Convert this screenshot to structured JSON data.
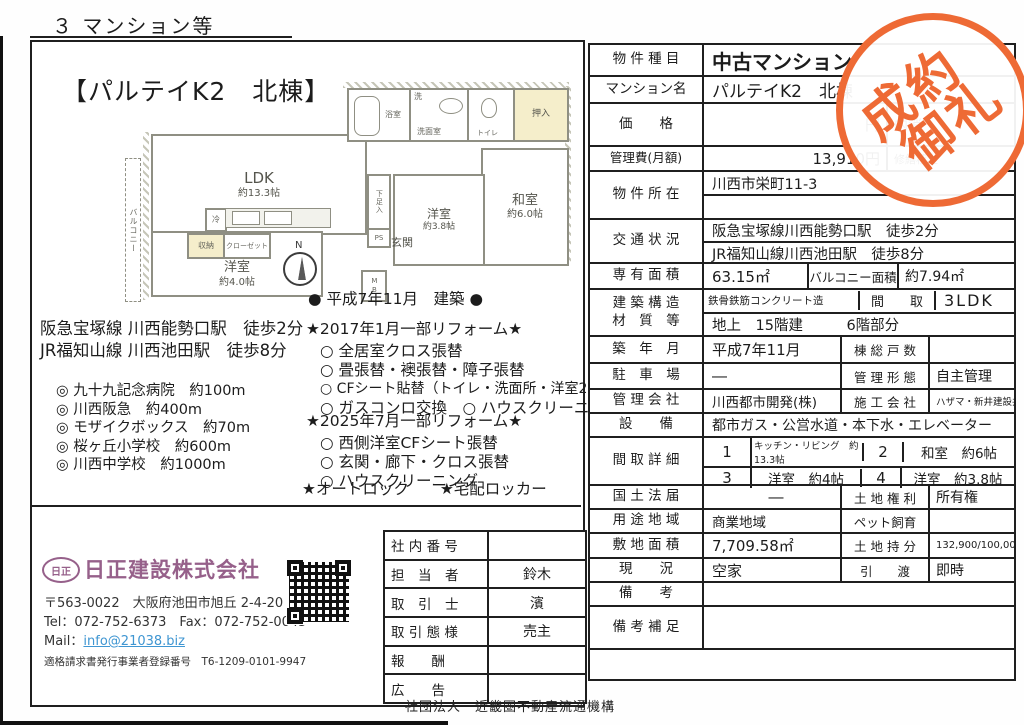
{
  "colors": {
    "stamp": "#ee6a35",
    "accent_purple": "#96608a",
    "link_blue": "#3f96d2",
    "tatami_yellow": "#f5eecb"
  },
  "page": {
    "header": "３ マンション等",
    "footer": "社団法人　近畿圏不動産流通機構"
  },
  "stamp": {
    "line1": "成約",
    "line2": "御礼"
  },
  "left": {
    "title": "【パルテイK2　北棟】",
    "built_note": "● 平成7年11月　建築 ●",
    "stations": [
      "阪急宝塚線 川西能勢口駅　徒歩2分",
      "JR福知山線 川西池田駅　徒歩8分"
    ],
    "nearby": [
      "◎ 九十九記念病院　約100m",
      "◎ 川西阪急　約400m",
      "◎ モザイクボックス　約70m",
      "◎ 桜ヶ丘小学校　約600m",
      "◎ 川西中学校　約1000m"
    ],
    "reform2017_title": "★2017年1月一部リフォーム★",
    "reform2017": [
      "○ 全居室クロス張替",
      "○ 畳張替・襖張替・障子張替",
      "○ CFシート貼替（トイレ・洗面所・洋室2部屋）",
      "○ ガスコンロ交換　○ ハウスクリーニング"
    ],
    "reform2025_title": "★2025年7月一部リフォーム★",
    "reform2025": [
      "○ 西側洋室CFシート張替",
      "○ 玄関・廊下・クロス張替",
      "○ ハウスクリーニング"
    ],
    "features": "★オートロック　　★宅配ロッカー"
  },
  "floorplan": {
    "balcony": "バルコニー",
    "ldk": "LDK",
    "ldk_size": "約13.3帖",
    "washitsu": "和室",
    "washitsu_size": "約6.0帖",
    "mid_room": "洋室",
    "mid_room_size": "約3.8帖",
    "west_room": "洋室",
    "west_room_size": "約4.0帖",
    "bath": "浴室",
    "wash": "洗",
    "wash_room": "洗面室",
    "toilet": "トイレ",
    "oshiire": "押入",
    "genkan": "玄関",
    "shoe_box": "下足入",
    "ps": "PS",
    "mb": "MB",
    "fridge": "冷",
    "storage": "収納",
    "closet": "クローゼット",
    "north": "N"
  },
  "company": {
    "logo": "日正",
    "name": "日正建設株式会社",
    "address": "〒563-0022　大阪府池田市旭丘 2-4-20",
    "tel_fax": "Tel：072-752-6373　Fax：072-752-0045",
    "mail_label": "Mail：",
    "mail": "info@21038.biz",
    "invoice": "適格請求書発行事業者登録番号　T6-1209-0101-9947"
  },
  "agent": {
    "rows": [
      {
        "label": "社 内 番 号",
        "value": ""
      },
      {
        "label": "担　当　者",
        "value": "鈴木"
      },
      {
        "label": "取　引　士",
        "value": "濱"
      },
      {
        "label": "取 引 態 様",
        "value": "売主"
      },
      {
        "label": "報　　酬",
        "value": ""
      },
      {
        "label": "広　　告",
        "value": ""
      }
    ]
  },
  "property": {
    "type": {
      "label": "物 件 種 目",
      "value": "中古マンション"
    },
    "name": {
      "label": "マンション名",
      "value": "パルテイK2　北棟"
    },
    "price": {
      "label": "価　　格",
      "value": "円",
      "sub_label": "内消"
    },
    "fee": {
      "label": "管理費(月額)",
      "value": "13,910円",
      "sub_label": "修繕積立"
    },
    "location": {
      "label": "物 件 所 在",
      "value": "川西市栄町11-3",
      "value2": ""
    },
    "access": {
      "label": "交 通 状 況",
      "line1": "阪急宝塚線川西能勢口駅　徒歩2分",
      "line2": "JR福知山線川西池田駅　徒歩8分"
    },
    "area": {
      "label": "専 有 面 積",
      "value": "63.15㎡",
      "sub_label": "バルコニー面積",
      "sub_value": "約7.94㎡"
    },
    "structure": {
      "label1": "建 築 構 造",
      "label2": "材　質　等",
      "value": "鉄骨鉄筋コンクリート造",
      "sub_label": "間　　取",
      "sub_value": "3LDK",
      "line2": "地上　15階建　　　6階部分"
    },
    "built": {
      "label": "築　年　月",
      "value": "平成7年11月",
      "sub_label": "棟 総 戸 数",
      "sub_value": ""
    },
    "parking": {
      "label": "駐　車　場",
      "value": "―",
      "sub_label": "管 理 形 態",
      "sub_value": "自主管理"
    },
    "mgmt": {
      "label": "管 理 会 社",
      "value": "川西都市開発(株)",
      "sub_label": "施 工 会 社",
      "sub_value": "ハザマ・新井建設共同企業体"
    },
    "facilities": {
      "label": "設　　備",
      "value": "都市ガス・公営水道・本下水・エレベーター"
    },
    "layout": {
      "label": "間 取 詳 細",
      "n1": "1",
      "d1": "キッチン・リビング　約13.3帖",
      "n2": "2",
      "d2": "和室　約6帖",
      "n3": "3",
      "d3": "洋室　約4帖",
      "n4": "4",
      "d4": "洋室　約3.8帖"
    },
    "land_law": {
      "label": "国 土 法 届",
      "value": "―",
      "sub_label": "土 地 権 利",
      "sub_value": "所有権"
    },
    "zoning": {
      "label": "用 途 地 域",
      "value": "商業地域",
      "sub_label": "ペット飼育",
      "sub_value": ""
    },
    "site_area": {
      "label": "敷 地 面 積",
      "value": "7,709.58㎡",
      "sub_label": "土 地 持 分",
      "sub_value": "132,900/100,000,000"
    },
    "status": {
      "label": "現　　況",
      "value": "空家",
      "sub_label": "引　　渡",
      "sub_value": "即時"
    },
    "remarks": {
      "label": "備　　考",
      "value": ""
    },
    "remarks2": {
      "label": "備 考 補 足",
      "value": ""
    }
  }
}
